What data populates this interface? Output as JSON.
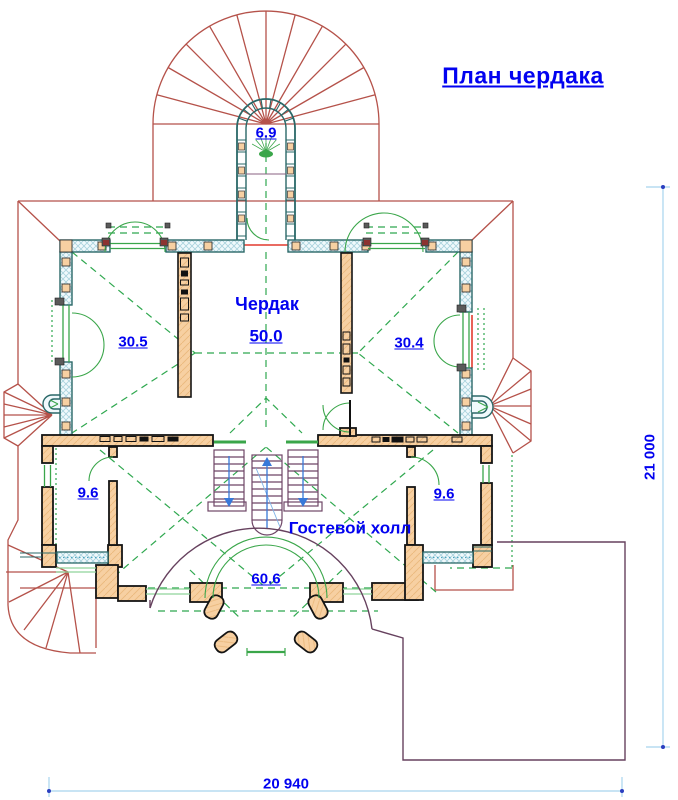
{
  "title": "План чердака",
  "labels": {
    "tower_area": "6.9",
    "attic_name": "Чердак",
    "attic_area": "50.0",
    "attic_left_area": "30.5",
    "attic_right_area": "30.4",
    "room_left_area": "9.6",
    "room_right_area": "9.6",
    "hall_name": "Гостевой холл",
    "hall_area": "60.6"
  },
  "dimensions": {
    "overall_width": "20 940",
    "overall_height": "21 000"
  },
  "colors": {
    "label_blue": "#0202f0",
    "roof_red": "#b5524a",
    "accent_red": "#e23a2e",
    "wall_teal": "#2a6868",
    "wall_tan": "#f7d0a2",
    "glazing_green": "#3aa64a",
    "projection_green_dashed": "#2fa84f",
    "stair_purple": "#6e4566",
    "terrace_purple": "#66415e",
    "dimension_line_blue": "#a8d4ee",
    "stair_arrow_blue": "#3779d9"
  }
}
